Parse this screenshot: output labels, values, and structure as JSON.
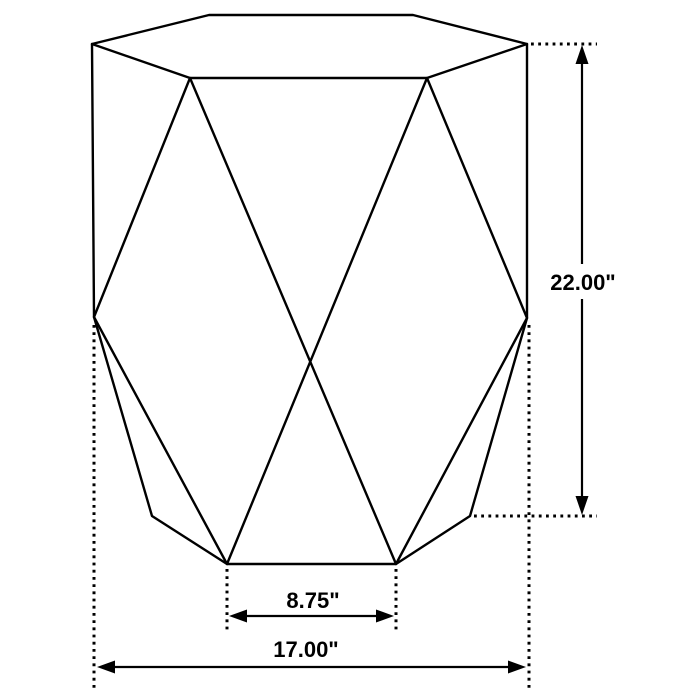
{
  "figure": {
    "name": "hexagonal-accent-table-dimension-diagram",
    "background_color": "#ffffff",
    "line_color": "#000000"
  },
  "dimensions": {
    "height": {
      "label": "22.00\""
    },
    "overall_width": {
      "label": "17.00\""
    },
    "base_edge_width": {
      "label": "8.75\""
    }
  },
  "geometry": {
    "table": {
      "top_hexagon": "M 92,44 L 209,15 L 413,15 L 527,44 L 427,78 L 190,78 Z",
      "facet_edges": "M 92,44 L 94,317 M 527,44 L 527,318 M 190,78 L 94,317 M 427,78 L 527,318 M 190,78 L 396,564 M 427,78 L 227,564 M 94,317 L 227,564 M 527,318 L 396,564",
      "base_outline": "M 94,317 L 152,516 L 227,564 L 396,564 L 470,516 L 527,318"
    },
    "extension_lines": {
      "height_top": "M 531,44 L 597,44",
      "height_bottom": "M 474,516 L 597,516",
      "width_left": "M 94,325 L 94,689",
      "width_right": "M 529,325 L 529,689",
      "base_left": "M 227,569 L 227,632",
      "base_right": "M 396,569 L 396,632"
    },
    "dimension_lines": {
      "height_upper": "M 582,61 L 582,264",
      "height_lower": "M 582,299 L 582,499",
      "width": "M 112,667 L 512,667",
      "base": "M 244,616 L 379,616"
    },
    "arrowheads": {
      "height_up": "582,45 575.5,64 588.5,64",
      "height_down": "582,515 575.5,496 588.5,496",
      "width_left": "97,667 115,660.5 115,673.5",
      "width_right": "526,667 508,660.5 508,673.5",
      "base_left": "229,616 247,609.5 247,622.5",
      "base_right": "394,616 376,609.5 376,622.5"
    }
  }
}
